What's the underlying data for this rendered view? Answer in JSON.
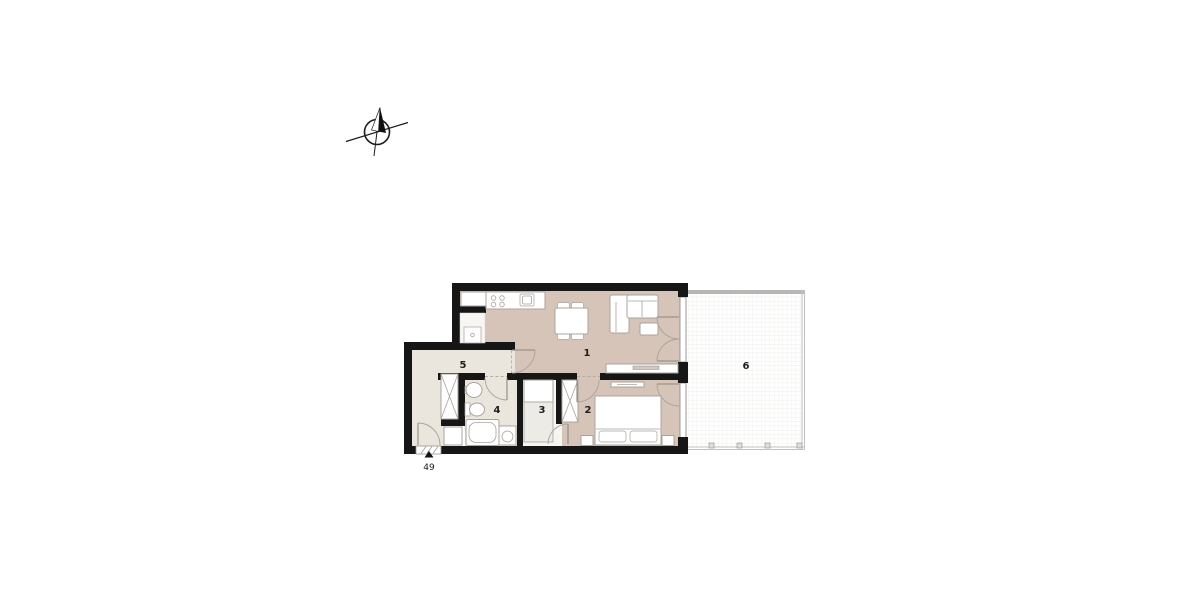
{
  "floor_plan": {
    "unit_label": "49",
    "rooms": [
      {
        "label": "1"
      },
      {
        "label": "2"
      },
      {
        "label": "3"
      },
      {
        "label": "4"
      },
      {
        "label": "5"
      },
      {
        "label": "6"
      }
    ]
  },
  "icons": {
    "compass": "north-arrow",
    "entrance": "entrance-arrow"
  },
  "colors": {
    "wall": "#161616",
    "floor_main": "#d5c4b7",
    "floor_service": "#eae5dd",
    "floor_closet": "#f6f5f1",
    "outline": "#a8a39c",
    "terrace_line": "#c1c1bf"
  }
}
